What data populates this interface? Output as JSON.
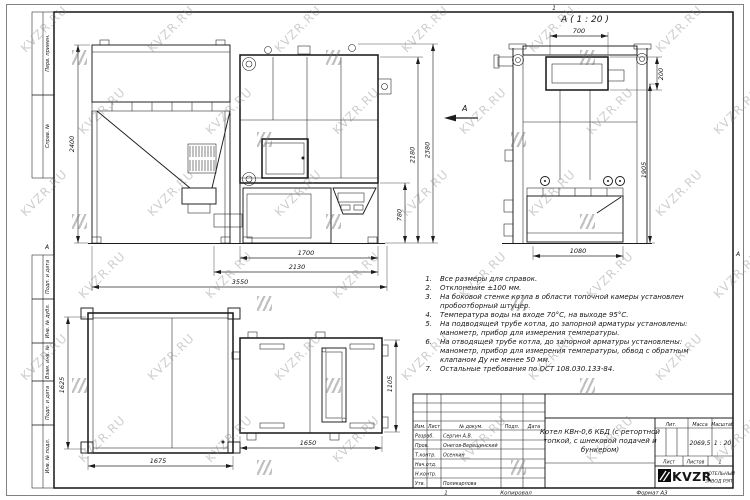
{
  "watermark": {
    "text": "KVZR.RU"
  },
  "frame": {
    "margin_labels": [
      "Перв. примен.",
      "Справ. №",
      "Подп. и дата",
      "Инв. № дубл.",
      "Взам. инв. №",
      "Подп. и дата",
      "Инв. № подл."
    ],
    "zone_top": "1",
    "zone_left": "А",
    "zone_right": "А"
  },
  "views": {
    "section_label": "А ( 1 : 20 )",
    "view_arrow_label": "А"
  },
  "dimensions": {
    "bunker_height": "2400",
    "boiler_total_height": "2380",
    "boiler_body_height": "2180",
    "ash_section_height": "780",
    "boiler_base_width": "1700",
    "base_with_feeder": "2130",
    "total_length": "3550",
    "bunker_top_depth": "1625",
    "bunker_top_width": "1675",
    "boiler_top_length": "1650",
    "boiler_top_depth": "1105",
    "section_top_width": "700",
    "section_top_height": "200",
    "section_height": "1905",
    "section_width": "1080"
  },
  "notes": {
    "lines": [
      {
        "n": "1.",
        "t": "Все размеры для справок."
      },
      {
        "n": "2.",
        "t": "Отклонение ±100 мм."
      },
      {
        "n": "3.",
        "t": "На боковой стенке котла в области топочной камеры установлен"
      },
      {
        "n": "",
        "t": "пробоотборный штуцер."
      },
      {
        "n": "4.",
        "t": "Температура воды на входе 70°С, на выходе 95°С."
      },
      {
        "n": "5.",
        "t": "На подводящей трубе котла, до запорной арматуры установлены:"
      },
      {
        "n": "",
        "t": "манометр, прибор для измерения температуры."
      },
      {
        "n": "6.",
        "t": "На отводящей трубе котла, до запорной арматуры установлены:"
      },
      {
        "n": "",
        "t": "манометр, прибор для измерения температуры, обвод с обратным"
      },
      {
        "n": "",
        "t": "клапаном Ду не менее 50 мм."
      },
      {
        "n": "7.",
        "t": "Остальные требования по ОСТ 108.030.133-84."
      }
    ]
  },
  "title_block": {
    "col_izm": "Изм.",
    "col_list": "Лист",
    "col_doc": "№ докум.",
    "col_podp": "Подп.",
    "col_data": "Дата",
    "rows": [
      {
        "label": "Разраб.",
        "name": "Сергин А.В."
      },
      {
        "label": "Пров.",
        "name": "Онегов-Верещинский"
      },
      {
        "label": "Т.контр.",
        "name": "Осенкин"
      },
      {
        "label": "Нач.отд.",
        "name": ""
      },
      {
        "label": "Н.контр.",
        "name": ""
      },
      {
        "label": "Утв.",
        "name": "Поликарпова"
      }
    ],
    "title_line1": "Котел КВн-0,6 КБД (с ретортной",
    "title_line2": "топкой, с шнековой подачей и",
    "title_line3": "бункером)",
    "lit_header": "Лит.",
    "mass_header": "Масса",
    "scale_header": "Масштаб",
    "mass": "2069,5",
    "scale": "1 : 20",
    "sheet_label": "Лист",
    "sheets_label": "Листов",
    "sheets_value": "1",
    "logo": "KVZR",
    "company_line1": "КОТЕЛЬНЫЙ",
    "company_line2": "ЗАВОД РЭП"
  },
  "footer": {
    "num": "1",
    "copied": "Копировал",
    "format": "Формат А3"
  }
}
